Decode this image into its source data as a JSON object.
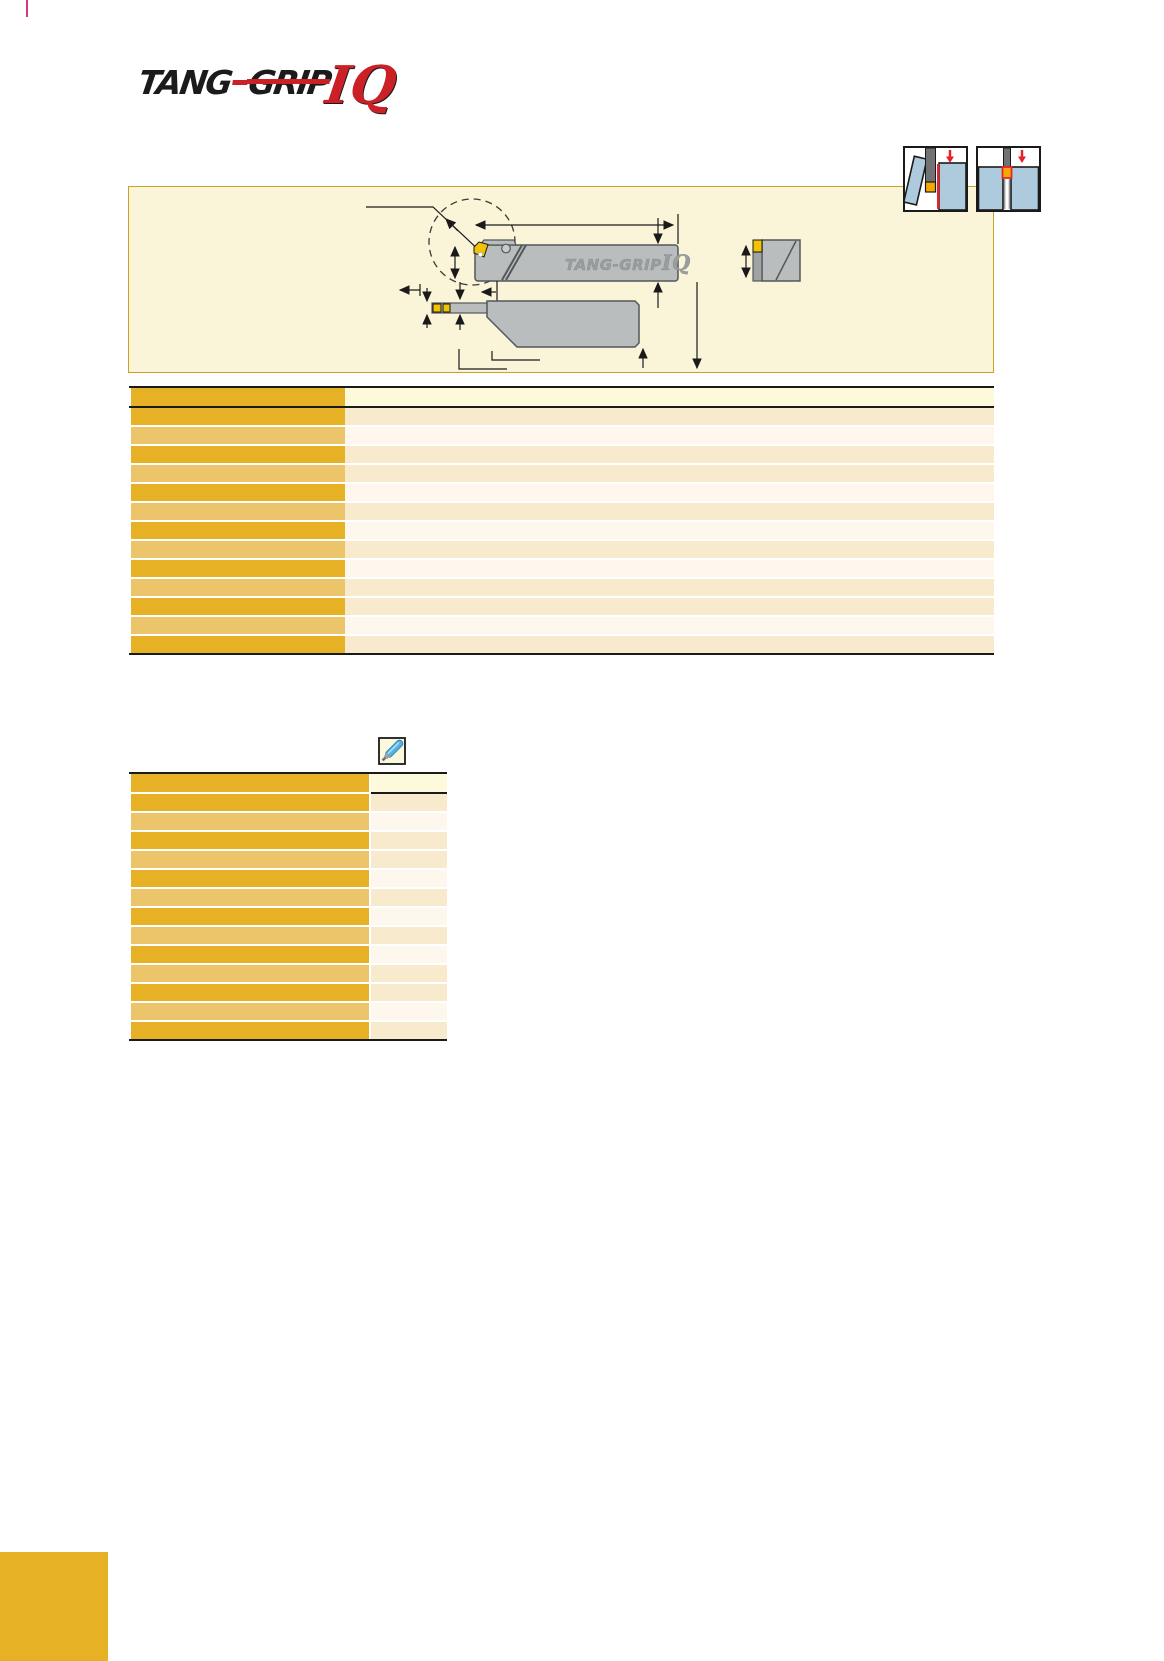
{
  "page": {
    "width": 1164,
    "height": 1661,
    "background": "#ffffff"
  },
  "logo": {
    "tang": "TANG",
    "grip": "GRIP",
    "iq": "IQ",
    "text_color": "#1b1b1b",
    "accent_color": "#cb2026"
  },
  "application_icons": {
    "left": {
      "name": "parting-application-icon"
    },
    "right": {
      "name": "grooving-application-icon"
    },
    "workpiece_color": "#AECBDD",
    "tool_color": "#707274",
    "insert_color": "#F5A802",
    "accent_red": "#E8212B"
  },
  "diagram_panel": {
    "background": "#FAF4D8",
    "border_color": "#C9A22C",
    "tool_body_color": "#B9BDBD",
    "tool_outline_color": "#53575A",
    "insert_color": "#F2C205",
    "dimension_color": "#1a1a1a",
    "emboss_tang": "TANG-GRIP",
    "emboss_iq": "IQ"
  },
  "palette": {
    "dark_gold": "#E7B125",
    "light_gold": "#ECC469",
    "cream": "#F8EBCD",
    "warm_white": "#FEF7EE",
    "header_pale": "#FCFADA",
    "border_black": "#1a1a1a",
    "footer_gold": "#E7B125",
    "crop_mark_pink": "#D9367F"
  },
  "table1": {
    "left_col_width": 214,
    "col_gap": 0,
    "header_height": 18,
    "row_height": 16.5,
    "row_gap": 2.5,
    "full_header_rule": true,
    "rows": [
      {
        "left": "dark",
        "right": "cream"
      },
      {
        "left": "light",
        "right": "warm"
      },
      {
        "left": "dark",
        "right": "cream"
      },
      {
        "left": "light",
        "right": "cream"
      },
      {
        "left": "dark",
        "right": "warm"
      },
      {
        "left": "light",
        "right": "cream"
      },
      {
        "left": "dark",
        "right": "warm"
      },
      {
        "left": "light",
        "right": "cream"
      },
      {
        "left": "dark",
        "right": "warm"
      },
      {
        "left": "light",
        "right": "cream"
      },
      {
        "left": "dark",
        "right": "cream"
      },
      {
        "left": "light",
        "right": "warm"
      },
      {
        "left": "dark",
        "right": "cream"
      }
    ]
  },
  "table2": {
    "left_col_width": 238,
    "col_gap": 2,
    "header_height": 18,
    "row_height": 16.5,
    "row_gap": 2.5,
    "full_header_rule": false,
    "rows": [
      {
        "left": "dark",
        "right": "cream"
      },
      {
        "left": "light",
        "right": "warm"
      },
      {
        "left": "dark",
        "right": "cream"
      },
      {
        "left": "light",
        "right": "cream"
      },
      {
        "left": "dark",
        "right": "warm"
      },
      {
        "left": "light",
        "right": "cream"
      },
      {
        "left": "dark",
        "right": "warm"
      },
      {
        "left": "light",
        "right": "cream"
      },
      {
        "left": "dark",
        "right": "warm"
      },
      {
        "left": "light",
        "right": "cream"
      },
      {
        "left": "dark",
        "right": "cream"
      },
      {
        "left": "light",
        "right": "warm"
      },
      {
        "left": "dark",
        "right": "cream"
      }
    ]
  },
  "tools_icon": {
    "name": "screwdriver-icon",
    "box_background": "#FCF8DE",
    "handle_color": "#55B1E4"
  }
}
